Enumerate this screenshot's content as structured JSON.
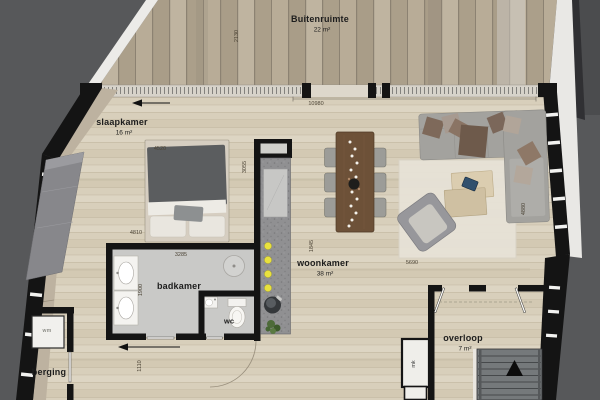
{
  "rooms": {
    "buitenruimte": {
      "name": "Buitenruimte",
      "area": "22 m²"
    },
    "slaapkamer": {
      "name": "slaapkamer",
      "area": "16 m²"
    },
    "badkamer": {
      "name": "badkamer"
    },
    "wc": {
      "name": "wc"
    },
    "woonkamer": {
      "name": "woonkamer",
      "area": "38 m²"
    },
    "overloop": {
      "name": "overloop",
      "area": "7 m²"
    },
    "berging": {
      "name": "berging"
    },
    "mk": {
      "name": "mk"
    },
    "wm": {
      "name": "wm"
    }
  },
  "dimensions": {
    "terrace_width": "10980",
    "terrace_depth": "2130",
    "bed_width": "4520",
    "bedroom_width": "4810",
    "bedroom_depth": "3055",
    "bathroom_width": "3285",
    "bathroom_depth": "1900",
    "kitchen_zone": "1845",
    "living_width": "5690",
    "living_depth": "4880",
    "storage_width": "1110"
  },
  "colors": {
    "outside": "#57585a",
    "wall": "#141414",
    "floor": "#d8cfbb",
    "tile": "#c9c9c7",
    "knee": "#bdb2a0",
    "railing": "#d7d3ca",
    "deck_wood": "#b2a691",
    "counter": "#909092",
    "burner_yellow": "#e8e13d",
    "sofa_gray": "#a3a29e",
    "table_wood": "#6d5138",
    "rug": "#e7e2d7",
    "stairs": "#75797b",
    "plant_green": "#4e6b39",
    "dim": "#4c4436",
    "label": "#1d1d1d"
  }
}
